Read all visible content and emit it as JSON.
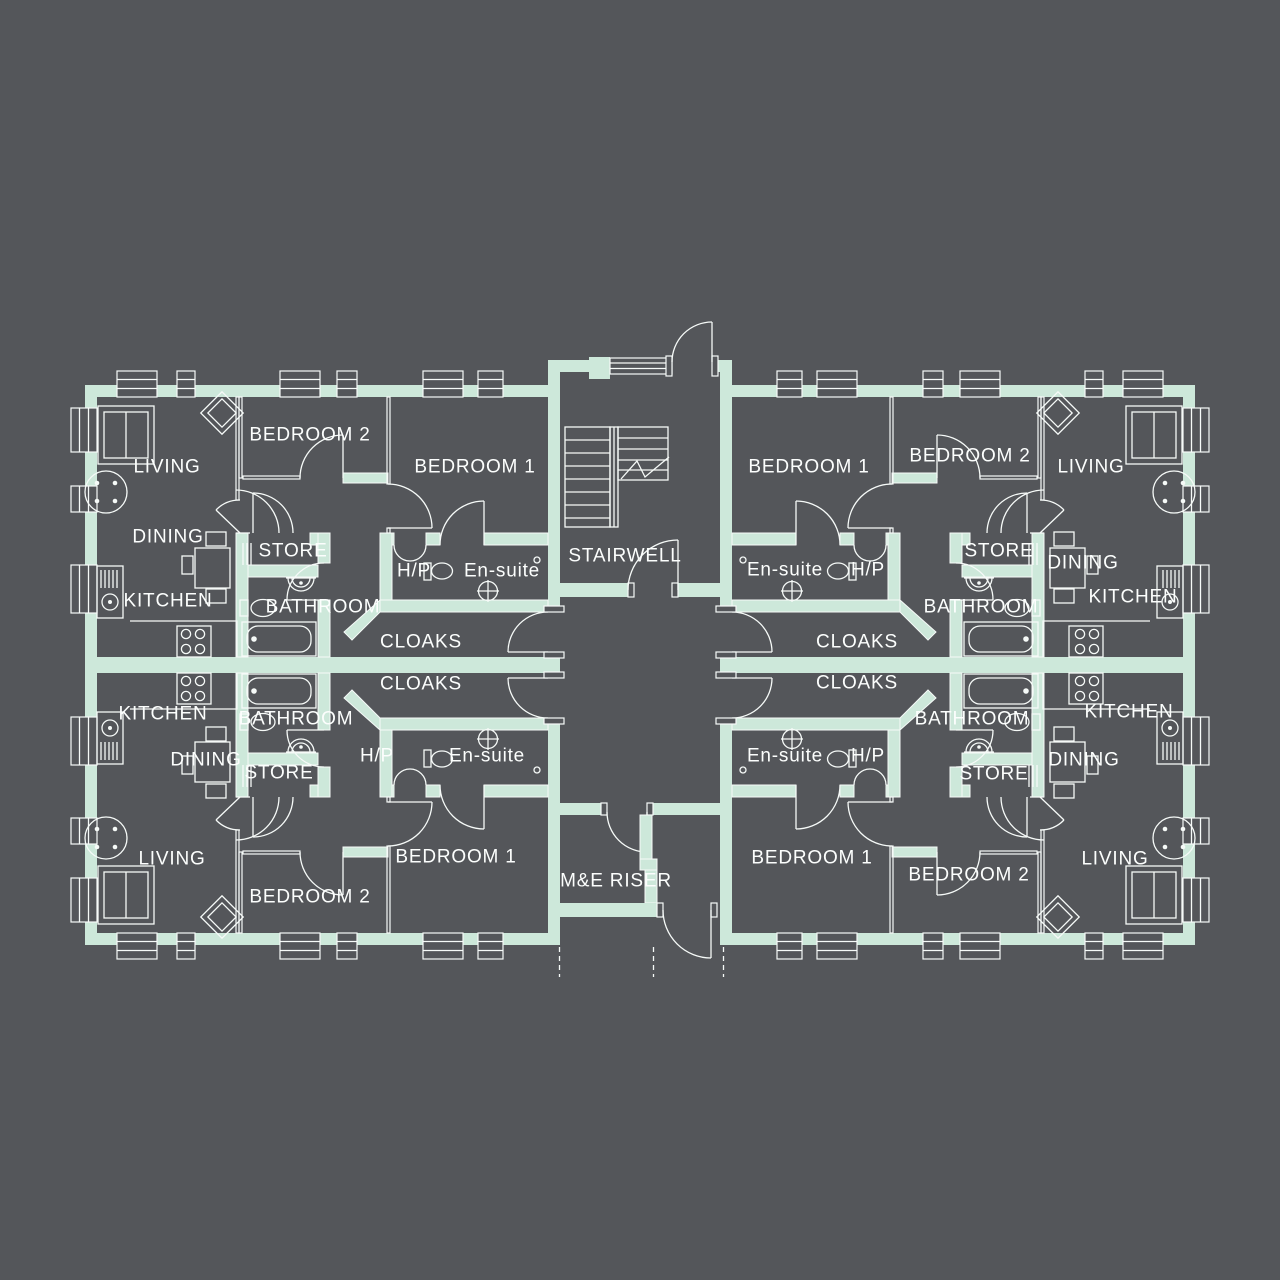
{
  "colors": {
    "background": "#54565a",
    "wall": "#cde8da",
    "line": "#f6faf8",
    "text": "#fcfefd"
  },
  "core": {
    "stairwell": "STAIRWELL",
    "me_riser": "M&E RISER"
  },
  "apts": {
    "tl": {
      "living": "LIVING",
      "dining": "DINING",
      "kitchen": "KITCHEN",
      "bedroom1": "BEDROOM 1",
      "bedroom2": "BEDROOM 2",
      "bathroom": "BATHROOM",
      "store": "STORE",
      "ensuite": "En-suite",
      "heat_point": "H/P",
      "cloaks": "CLOAKS"
    },
    "tr": {
      "living": "LIVING",
      "dining": "DINING",
      "kitchen": "KITCHEN",
      "bedroom1": "BEDROOM 1",
      "bedroom2": "BEDROOM 2",
      "bathroom": "BATHROOM",
      "store": "STORE",
      "ensuite": "En-suite",
      "heat_point": "H/P",
      "cloaks": "CLOAKS"
    },
    "bl": {
      "living": "LIVING",
      "dining": "DINING",
      "kitchen": "KITCHEN",
      "bedroom1": "BEDROOM 1",
      "bedroom2": "BEDROOM 2",
      "bathroom": "BATHROOM",
      "store": "STORE",
      "ensuite": "En-suite",
      "heat_point": "H/P",
      "cloaks": "CLOAKS"
    },
    "br": {
      "living": "LIVING",
      "dining": "DINING",
      "kitchen": "KITCHEN",
      "bedroom1": "BEDROOM 1",
      "bedroom2": "BEDROOM 2",
      "bathroom": "BATHROOM",
      "store": "STORE",
      "ensuite": "En-suite",
      "heat_point": "H/P",
      "cloaks": "CLOAKS"
    }
  }
}
